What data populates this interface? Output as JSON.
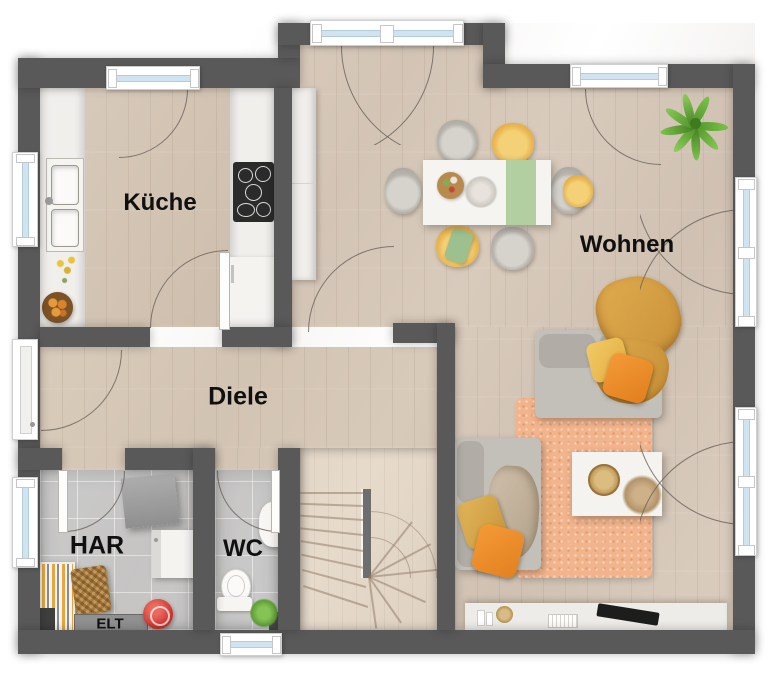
{
  "rooms": [
    {
      "id": "kueche",
      "label": "Küche"
    },
    {
      "id": "wohnen",
      "label": "Wohnen"
    },
    {
      "id": "diele",
      "label": "Diele"
    },
    {
      "id": "har",
      "label": "HAR"
    },
    {
      "id": "wc",
      "label": "WC"
    },
    {
      "id": "elt",
      "label": "ELT"
    }
  ],
  "colors": {
    "wall": "#595959",
    "floor_wood": "#d6c7b6",
    "floor_tile": "#cbcbcb",
    "stairs_wood": "#e6dacb",
    "rug": "#f2b48c",
    "sofa": "#c3bfb9",
    "accent_orange": "#ee8f2e",
    "accent_gold": "#d9a94e",
    "accent_mustard": "#d7a145",
    "runner_green": "#b2cfa2",
    "plant_green": "#76bd3f",
    "window_glass": "#cfe4f0",
    "appliance_dark": "#2b2b2b",
    "vacuum_red": "#c62f28"
  }
}
